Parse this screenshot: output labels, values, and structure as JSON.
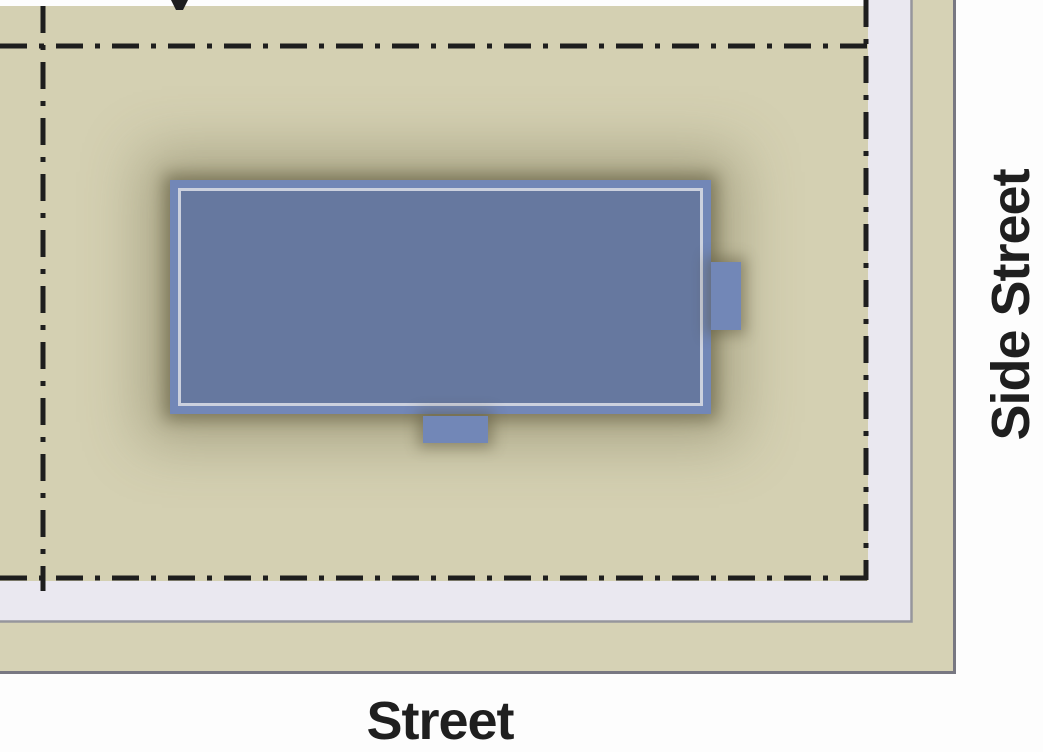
{
  "diagram": {
    "type": "site-plan",
    "labels": {
      "street": "Street",
      "side_street": "Side Street"
    },
    "colors": {
      "page_background": "#fdfdfd",
      "lot_fill": "#d4d0b2",
      "sidewalk_fill": "#eae8f0",
      "planting_strip_fill": "#d6d2b5",
      "sidewalk_edge_line": "#96969c",
      "curb_line": "#787882",
      "lot_line": "#1e1e1e",
      "building_band_fill": "#7287b7",
      "building_interior_fill": "#66789f",
      "roof_inset_line": "#ccd1de",
      "label_text": "#1f1f1f"
    }
  }
}
